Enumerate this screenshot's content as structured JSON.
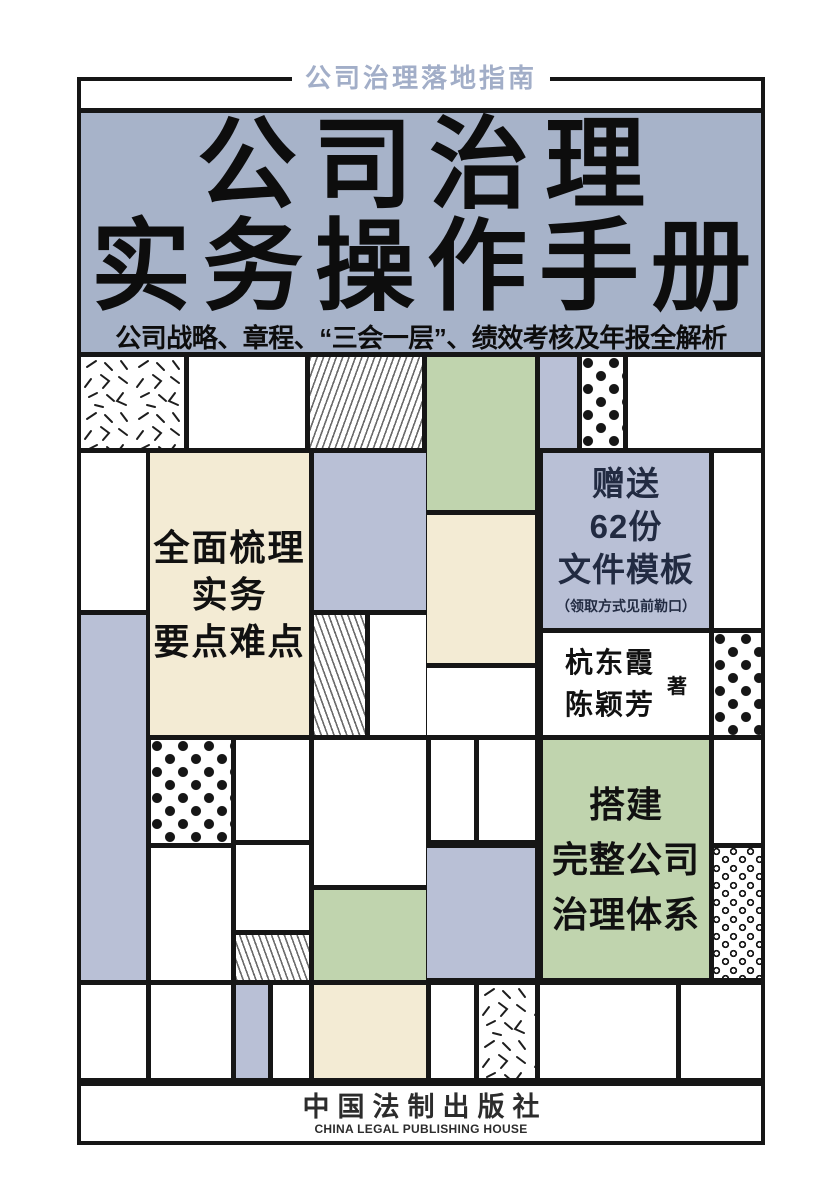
{
  "book": {
    "series_tagline": "公司治理落地指南",
    "title": {
      "line1": "公司治理",
      "line2": "实务操作手册"
    },
    "subtitle": "公司战略、章程、“三会一层”、绩效考核及年报全解析",
    "selling_points": {
      "left": "全面梳理\n实务\n要点难点",
      "right": "搭建\n完整公司\n治理体系"
    },
    "gift": {
      "main": "赠送\n62份\n文件模板",
      "note": "（领取方式见前勒口）"
    },
    "authors": {
      "names": "杭东霞\n陈颖芳",
      "role": "著"
    },
    "publisher": {
      "cn": "中国法制出版社",
      "en": "CHINA LEGAL PUBLISHING HOUSE"
    }
  },
  "colors": {
    "panel_blue": "#a7b3c9",
    "block_lavender": "#b9c0d6",
    "block_cream": "#f3ebd4",
    "block_green": "#c0d4ae",
    "ink": "#161616",
    "tagline_blue": "#a2aec8",
    "gift_text_navy": "#222b42"
  }
}
